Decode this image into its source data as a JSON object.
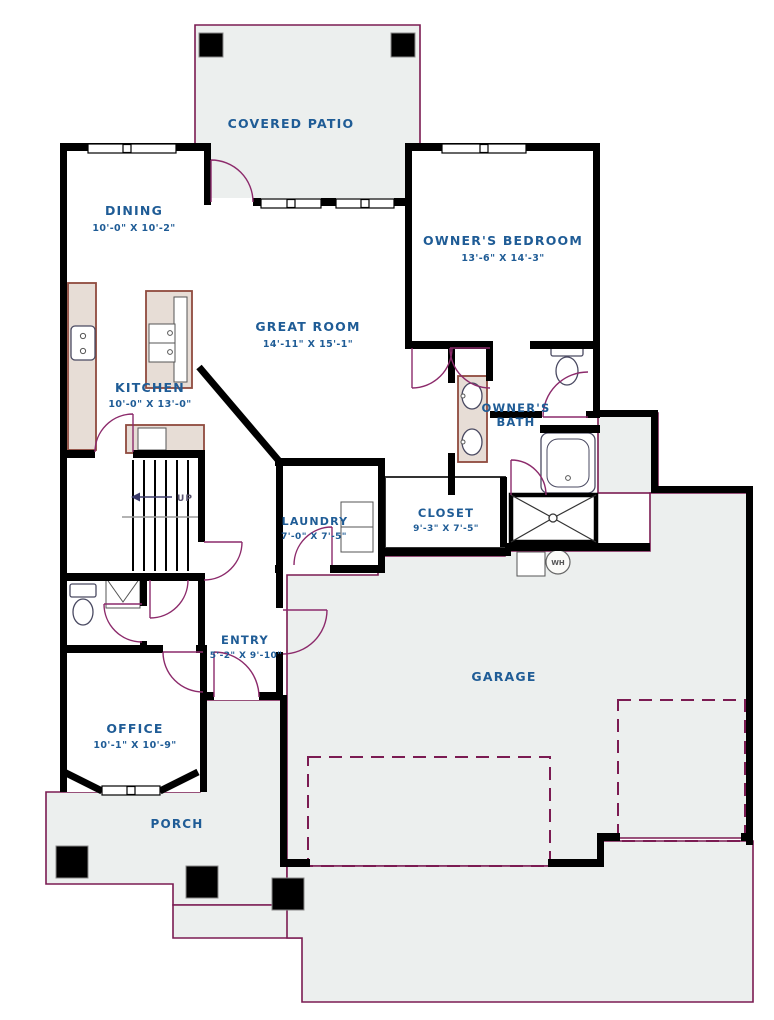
{
  "plan_type": "floor-plan",
  "rooms": {
    "covered_patio": {
      "name": "COVERED PATIO"
    },
    "dining": {
      "name": "DINING",
      "dims": "10'-0\" X 10'-2\""
    },
    "owners_bedroom": {
      "name": "OWNER'S BEDROOM",
      "dims": "13'-6\" X 14'-3\""
    },
    "great_room": {
      "name": "GREAT ROOM",
      "dims": "14'-11\" X 15'-1\""
    },
    "kitchen": {
      "name": "KITCHEN",
      "dims": "10'-0\" X 13'-0\""
    },
    "owners_bath": {
      "name_line1": "OWNER'S",
      "name_line2": "BATH"
    },
    "laundry": {
      "name": "LAUNDRY",
      "dims": "7'-0\" X 7'-5\""
    },
    "closet": {
      "name": "CLOSET",
      "dims": "9'-3\" X 7'-5\""
    },
    "entry": {
      "name": "ENTRY",
      "dims": "5'-2\" X 9'-10\""
    },
    "office": {
      "name": "OFFICE",
      "dims": "10'-1\" X 10'-9\""
    },
    "garage": {
      "name": "GARAGE"
    },
    "porch": {
      "name": "PORCH"
    }
  },
  "annotations": {
    "stairs_direction": "UP",
    "water_heater": "WH"
  },
  "colors": {
    "wall": "#000000",
    "site_outline": "#7b1b52",
    "label_text": "#1f5c96",
    "cabinetry": "#8f4a3e",
    "concrete_fill": "#ecefee"
  }
}
